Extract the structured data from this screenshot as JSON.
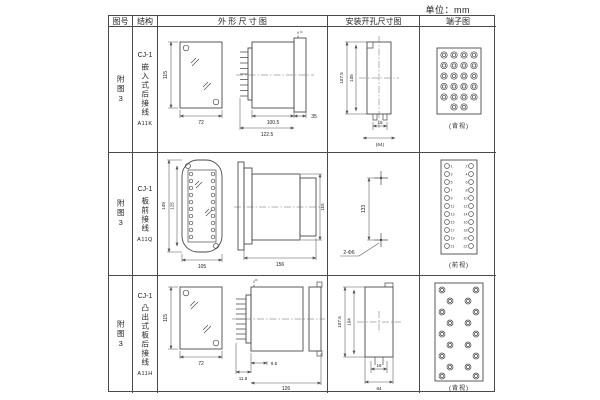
{
  "unit_label": "单位：mm",
  "header": {
    "fig_no": "图号",
    "structure": "结构",
    "outline": "外 形 尺 寸 图",
    "install": "安装开孔尺寸图",
    "terminal": "端子图"
  },
  "rows": [
    {
      "fig_no": "附图3",
      "model": "CJ-1",
      "structure_name": "嵌入式后接线",
      "code": "A11K",
      "outline": {
        "front_h": "115",
        "front_w": "72",
        "side_a": "100.5",
        "side_b": "122.5",
        "side_c": "35"
      },
      "install": {
        "v1": "107.5",
        "v2": "105",
        "h1": "16",
        "h2": "(64)"
      },
      "terminal": {
        "view_label": "(背视)"
      }
    },
    {
      "fig_no": "附图3",
      "model": "CJ-1",
      "structure_name": "板前接线",
      "code": "A11Q",
      "outline": {
        "front_h": "149",
        "front_h2": "125",
        "front_w": "105",
        "side_a": "156",
        "side_b": "115"
      },
      "install": {
        "v1": "133",
        "holes_label": "2-Φ6"
      },
      "terminal": {
        "view_label": "(前视)",
        "left_numbers": [
          1,
          3,
          5,
          7,
          9,
          11,
          13,
          15,
          17,
          19,
          21
        ],
        "right_numbers": [
          2,
          4,
          6,
          8,
          10,
          12,
          14,
          16,
          18,
          20,
          22
        ]
      }
    },
    {
      "fig_no": "附图3",
      "model": "CJ-1",
      "structure_name": "凸出式板后接线",
      "code": "A11H",
      "outline": {
        "front_h": "115",
        "front_w": "72",
        "side_a": "9.5",
        "side_b": "11.5",
        "side_c": "126"
      },
      "install": {
        "v1": "107.5",
        "v2": "104",
        "h1": "16",
        "h2": "64"
      },
      "terminal": {
        "view_label": "(背视)"
      }
    }
  ]
}
